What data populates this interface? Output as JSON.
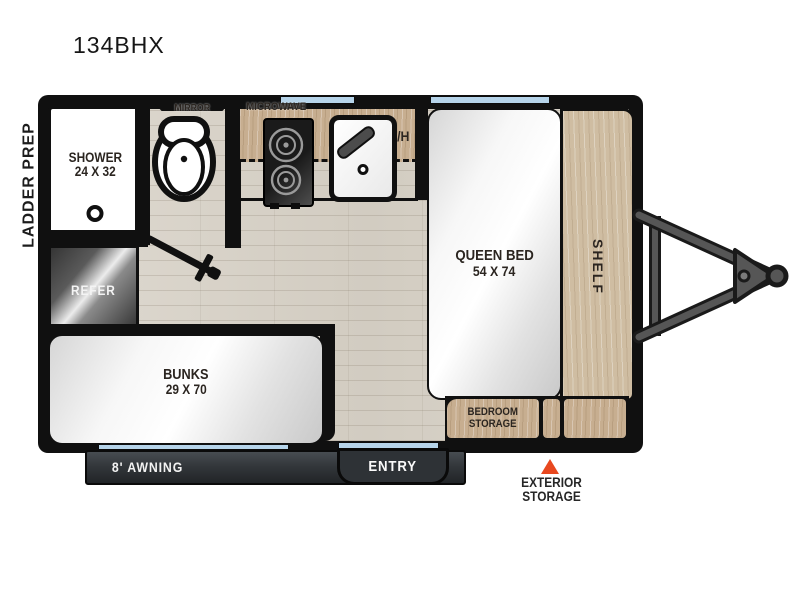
{
  "title": "134BHX",
  "exterior": {
    "ladder_prep": "LADDER PREP",
    "awning": "8' AWNING",
    "entry": "ENTRY",
    "exterior_storage_line1": "EXTERIOR",
    "exterior_storage_line2": "STORAGE"
  },
  "rooms": {
    "shower_label": "SHOWER",
    "shower_dims": "24 X 32",
    "mirror": "MIRROR",
    "microwave": "MICROWAVE",
    "overhead_cabinet": "O/H",
    "queen_bed_label": "QUEEN BED",
    "queen_bed_dims": "54 X 74",
    "shelf": "SHELF",
    "refrigerator": "REFER",
    "bunks_label": "BUNKS",
    "bunks_dims": "29 X 70",
    "bedroom_storage_line1": "BEDROOM",
    "bedroom_storage_line2": "STORAGE"
  },
  "colors": {
    "accent_marker": "#E8481F",
    "window_glass": "#B6D4EA",
    "wall": "#101010",
    "wood_cabinet": "#C7AE90",
    "floor": "#D9D4CA"
  }
}
